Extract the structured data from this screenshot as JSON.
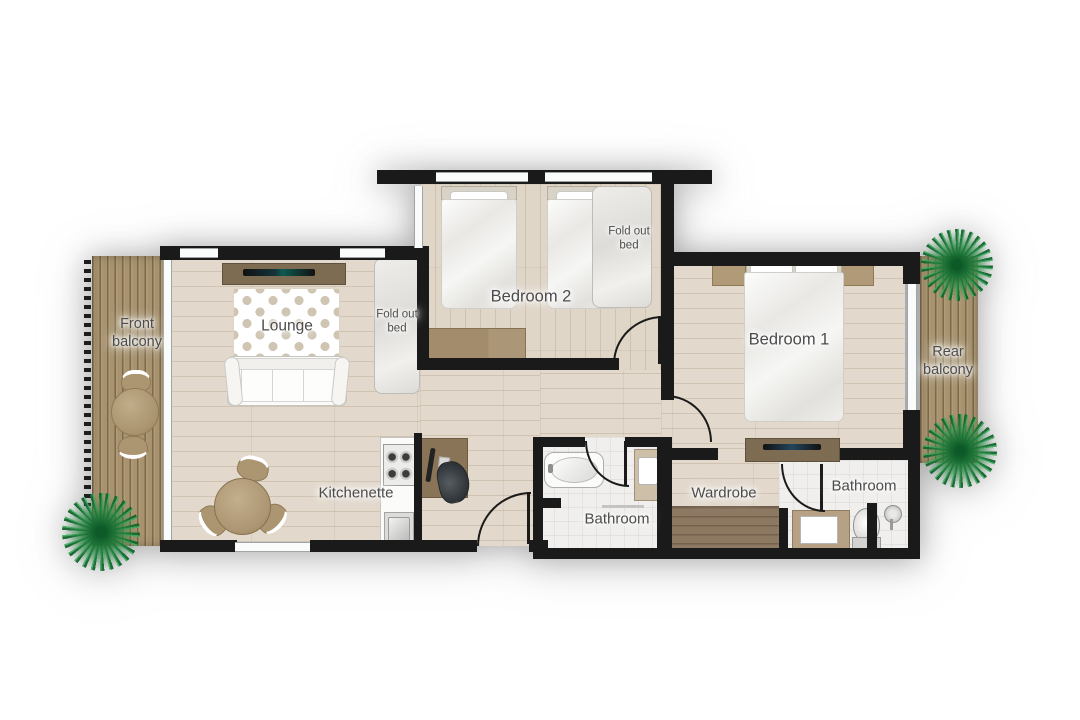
{
  "title": "Two bedroom apartment floor plan",
  "labels": {
    "front_balcony": "Front balcony",
    "lounge": "Lounge",
    "fold_out_bed": "Fold out bed",
    "bedroom_2": "Bedroom 2",
    "bedroom_1": "Bedroom 1",
    "rear_balcony": "Rear balcony",
    "kitchenette": "Kitchenette",
    "bathroom_main": "Bathroom",
    "wardrobe": "Wardrobe",
    "bathroom_second": "Bathroom"
  },
  "colors": {
    "wall": "#1a1a1a",
    "wood_floor": "#e2d8cb",
    "deck": "#a8936e",
    "tile_floor": "#f0efed",
    "plant_green": "#2e8c46",
    "furniture_tan": "#b09a78",
    "label_text": "#4c4c4c"
  }
}
